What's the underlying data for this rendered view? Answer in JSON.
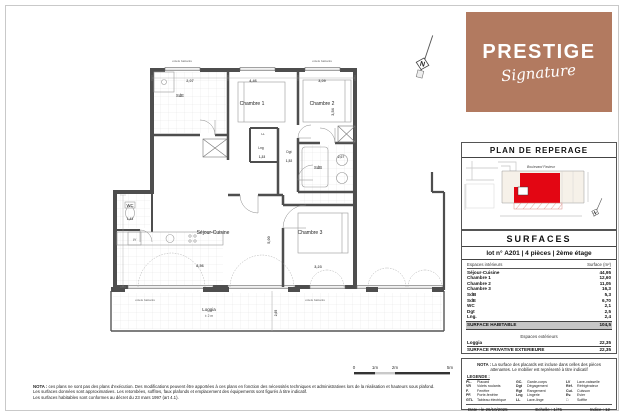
{
  "brand": {
    "name": "PRESTIGE",
    "sub": "Signature",
    "bg": "#b27a60"
  },
  "reperage": {
    "title": "PLAN DE REPERAGE",
    "street": "Boulevard Pasteur",
    "north": "N",
    "red": "#e30613"
  },
  "surfaces": {
    "title": "SURFACES",
    "lot_line": "lot n° A201 | 4 pièces | 2ème étage",
    "col_label": "Espaces intérieurs",
    "col_value": "Surface (m²)",
    "rows": [
      {
        "label": "Séjour-Cuisine",
        "value": "44,95"
      },
      {
        "label": "Chambre 1",
        "value": "12,60"
      },
      {
        "label": "Chambre 2",
        "value": "11,05"
      },
      {
        "label": "Chambre 3",
        "value": "16,3"
      },
      {
        "label": "SdB",
        "value": "5,3"
      },
      {
        "label": "SdE",
        "value": "6,70"
      },
      {
        "label": "WC",
        "value": "2,1"
      },
      {
        "label": "Dgt",
        "value": "2,5"
      },
      {
        "label": "Lng.",
        "value": "2,4"
      }
    ],
    "total_label": "SURFACE HABITABLE",
    "total_value": "104,5",
    "ext_header": "Espaces extérieurs",
    "ext_row": {
      "label": "Loggia",
      "value": "22,35"
    },
    "ext_total_label": "SURFACE PRIVATIVE EXTERIEURE",
    "ext_total_value": "22,35"
  },
  "legend_box": {
    "nota_bold": "NOTA :",
    "nota_text": "La surface des placards est incluse dans celles des pièces attenantes. Le mobilier est représenté à titre indicatif",
    "legende_label": "LEGENDE :",
    "items": [
      {
        "abbr": "PL.",
        "label": "Placard"
      },
      {
        "abbr": "VR",
        "label": "Volets roulants"
      },
      {
        "abbr": "F.",
        "label": "Fenêtre"
      },
      {
        "abbr": "PF.",
        "label": "Porte-fenêtre"
      },
      {
        "abbr": "GTL",
        "label": "Tableau électrique"
      },
      {
        "abbr": "GC.",
        "label": "Garde-corps"
      },
      {
        "abbr": "Dgt",
        "label": "Dégagement"
      },
      {
        "abbr": "Rgt",
        "label": "Rangement"
      },
      {
        "abbr": "Lng",
        "label": "Lingerie"
      },
      {
        "abbr": "LL",
        "label": "Lave-linge"
      },
      {
        "abbr": "LV",
        "label": "Lave-vaisselle"
      },
      {
        "abbr": "Réf.",
        "label": "Réfrigérateur"
      },
      {
        "abbr": "Cui.",
        "label": "Cuisson"
      },
      {
        "abbr": "Ev.",
        "label": "Evier"
      },
      {
        "abbr": "□",
        "label": "Soffite"
      }
    ],
    "date_label": "Date : le 26/10/2025",
    "echelle_label": "Echelle : 1/75",
    "indice_label": "Indice : 12"
  },
  "nota_main": {
    "bold": "NOTA :",
    "line1": "ces plans ne sont pas des plans d'exécution. Des modifications peuvent être apportées à ces plans en fonction des nécessités techniques et administratives lors de la réalisation et hauteurs sous plafond.",
    "line2": "Les surfaces données sont approximatives. Les retombées, soffites, faux plafonds et emplacement des équipements sont figurés à titre indicatif.",
    "line3": "Les surfaces habitables sont conformes au décret du 23 mars 1997 (art 4.1)."
  },
  "scale_bar": {
    "l0": "0",
    "l1": "1m",
    "l2": "2m",
    "l5": "5m"
  },
  "plan": {
    "north": "N",
    "volets": "volets battants",
    "rooms": {
      "sde": "SdE",
      "chambre1": "Chambre 1",
      "chambre2": "Chambre 2",
      "chambre3": "Chambre 3",
      "lng": "Lng",
      "ll": "LL",
      "dgt": "Dgt",
      "sdb": "SdB",
      "wc": "WC",
      "lv": "LV",
      "sejour": "Séjour-Cuisine",
      "loggia": "Loggia",
      "loggia_sub": "± 2 m"
    },
    "dims": {
      "sde_w": "2,07",
      "ch1_w": "4,46",
      "ch2_w": "3,09",
      "ch2_h": "3,54",
      "lng_w": "1,33",
      "dgt_w": "1,52",
      "sdb_w": "2,07",
      "wc_w": "1,43",
      "sejour_w": "8,56",
      "sejour_h": "5,00",
      "ch3_w": "3,23",
      "loggia_h": "2,65"
    }
  }
}
